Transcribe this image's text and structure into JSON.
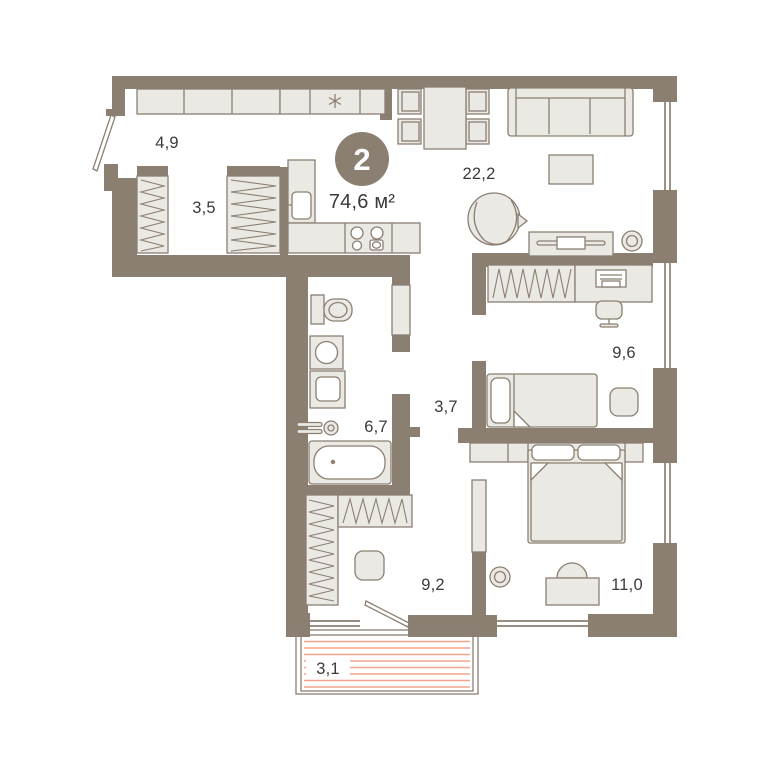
{
  "plan": {
    "badge": {
      "rooms_count": "2",
      "total_area": "74,6 м²"
    },
    "room_areas": {
      "entry_hall": "4,9",
      "wardrobe_hall": "3,5",
      "living_kitchen": "22,2",
      "bedroom_small": "9,6",
      "corridor": "3,7",
      "bathroom": "6,7",
      "inner_hall": "9,2",
      "bedroom_master": "11,0",
      "balcony": "3,1"
    },
    "icons": {
      "fridge": "snowflake-icon"
    },
    "colors": {
      "wall": "#8b7f72",
      "furniture_fill": "#ebe9e3",
      "outline": "#8b7f72",
      "balcony_stripe": "#f2a58d",
      "label_text": "#3a3a3a",
      "badge_fill": "#8b7f72",
      "badge_text": "#ffffff",
      "background": "#ffffff"
    }
  }
}
